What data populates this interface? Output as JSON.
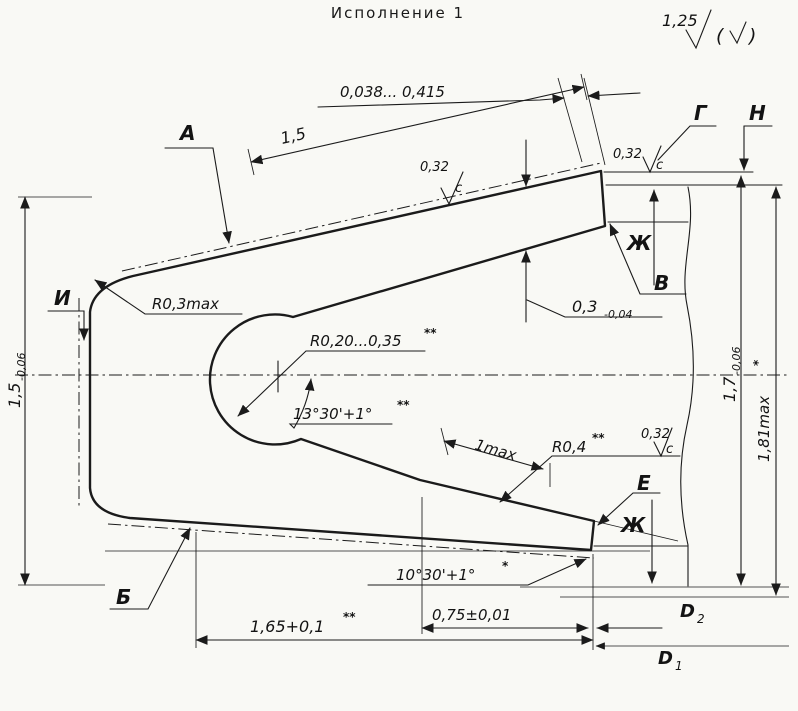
{
  "title": "Исполнение 1",
  "finish": {
    "value": "1,25",
    "alt_open": "(",
    "alt_close": ")"
  },
  "labels": {
    "a": "А",
    "g": "Г",
    "n": "Н",
    "i": "И",
    "v": "В",
    "e": "Е",
    "b": "Б",
    "zh": "Ж",
    "d1_base": "D",
    "d1_sub": "1",
    "d2_base": "D",
    "d2_sub": "2"
  },
  "dims": {
    "gap_range": "0,038... 0,415",
    "top_length": "1,5",
    "left_radius": "R0,3max",
    "inner_radius": "R0,20...0,35",
    "inner_radius_note": "**",
    "top_angle": "13°30'+1°",
    "top_angle_note": "**",
    "tip_thickness": "0,3",
    "tip_thickness_tol": "-0,04",
    "left_height": "1,5",
    "left_height_tol": "-0,06",
    "right_height": "1,7",
    "right_height_tol": "-0,06",
    "right_height_max": "1,81max",
    "right_height_max_note": "*",
    "land_length": "1max",
    "bottom_radius": "R0,4",
    "bottom_radius_note": "**",
    "bottom_angle": "10°30'+1°",
    "bottom_angle_note": "*",
    "slot_depth": "1,65+0,1",
    "slot_depth_note": "**",
    "land_width": "0,75±0,01",
    "roughness": "0,32",
    "roughness_letter": "c"
  }
}
